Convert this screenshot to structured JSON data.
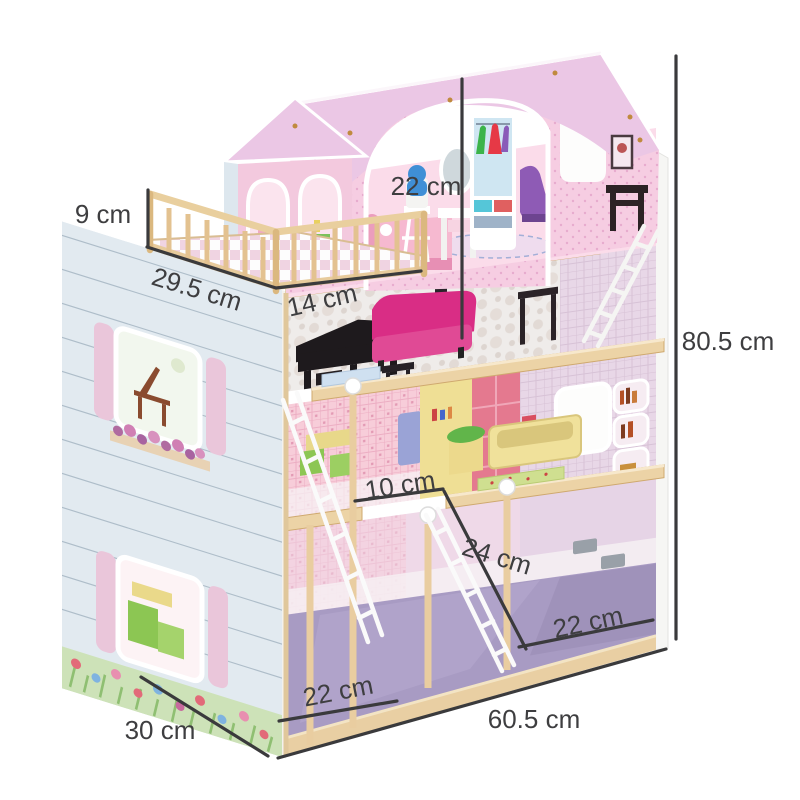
{
  "annotations": {
    "balcony_railing_height": {
      "label": "9 cm"
    },
    "balcony_depth": {
      "label": "29.5 cm"
    },
    "balcony_width": {
      "label": "14 cm"
    },
    "top_floor_height": {
      "label": "22 cm"
    },
    "total_height": {
      "label": "80.5 cm"
    },
    "hatch_width": {
      "label": "10 cm"
    },
    "ladder_length": {
      "label": "24 cm"
    },
    "bottom_room_right_width": {
      "label": "22 cm"
    },
    "bottom_room_left_width": {
      "label": "22 cm"
    },
    "total_width": {
      "label": "60.5 cm"
    },
    "total_depth": {
      "label": "30 cm"
    }
  },
  "colors": {
    "background": "#ffffff",
    "roof_pink": "#ebc7e5",
    "front_wall_pink": "#f6cde2",
    "side_siding_blue": "#e2eaf0",
    "wood_tan": "#ecd3a6",
    "floor_purple": "#a89bc3",
    "sofa_magenta": "#d92d85",
    "dimension_line": "#3a3a3c",
    "dimension_text": "#3e3e40"
  }
}
